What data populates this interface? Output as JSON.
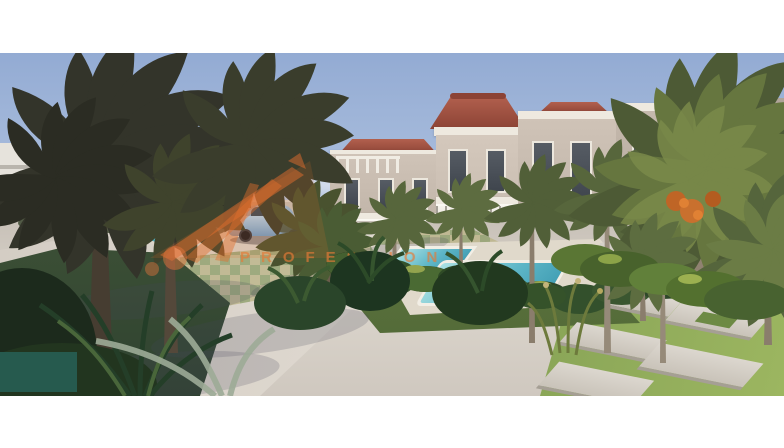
{
  "watermark": {
    "text": "PROFESSION",
    "logo": "sunray-logo",
    "color": "#e2733c"
  },
  "scene": {
    "subject": "Exterior 3D render of a two-storey beige villa compound",
    "visible_elements": [
      "two-storey beige villas with white trim and terracotta hip roofs",
      "balconies with white railings",
      "date palms with orange fruit clusters",
      "dark silhouetted palms on the left",
      "turquoise swimming pools with white coping",
      "paved driveway with green-tan checkerboard pavers",
      "light blue sports coupe",
      "dark red SUV in the distance",
      "stepping-stone path across lawn",
      "dense tropical shrubs and ferns",
      "white frame bands top and bottom",
      "dark teal rectangle at bottom left"
    ]
  },
  "palette": {
    "frame_white": "#ffffff",
    "sky_blue": "#93abd3",
    "horizon_haze": "#e8decf",
    "villa_wall": "#c9bdb1",
    "villa_trim": "#eee9df",
    "roof_terracotta": "#a3584a",
    "road_concrete": "#d8d1c8",
    "paver_tan": "#bdb68c",
    "paver_green": "#93a271",
    "pool_water": "#5fb7c8",
    "lawn_green": "#7d9a52",
    "palm_dark": "#33342a",
    "palm_green": "#5a6a40",
    "date_orange": "#bf6526",
    "car_blue": "#7fabd4",
    "suv_red": "#7e2a1e",
    "corner_swatch": "#265a4e",
    "watermark_orange": "#e2733c"
  }
}
